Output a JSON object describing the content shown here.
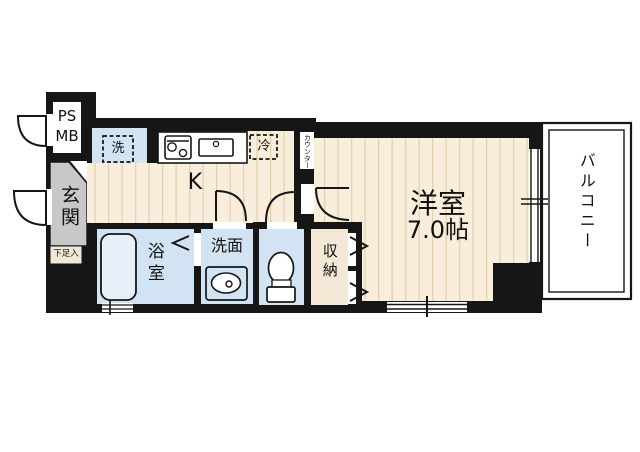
{
  "plan": {
    "type": "apartment-floor-plan",
    "labels": {
      "psmb_line1": "PS",
      "psmb_line2": "MB",
      "entrance": "玄関",
      "shoe_storage": "下足入",
      "laundry": "洗",
      "kitchen": "K",
      "refrigerator": "冷",
      "counter": "カウンター",
      "bathroom": "浴室",
      "washroom": "洗面",
      "closet": "収納",
      "main_room": "洋室",
      "main_room_size": "7.0帖",
      "balcony": "バルコニー"
    },
    "icons": [
      "door-swing-icon",
      "folding-door-arrow-icon",
      "stove-icon",
      "kitchen-sink-icon",
      "bathtub-icon",
      "washbasin-icon",
      "toilet-icon",
      "sliding-window-icon"
    ],
    "colors": {
      "wall": "#161616",
      "flooring": "#f8eedb",
      "flooring_stripe": "#e3d2b2",
      "wet_area": "#d2e4f3",
      "storage_beige": "#f2e8d5",
      "entrance_gray": "#c8c8c8",
      "background": "#ffffff"
    }
  }
}
